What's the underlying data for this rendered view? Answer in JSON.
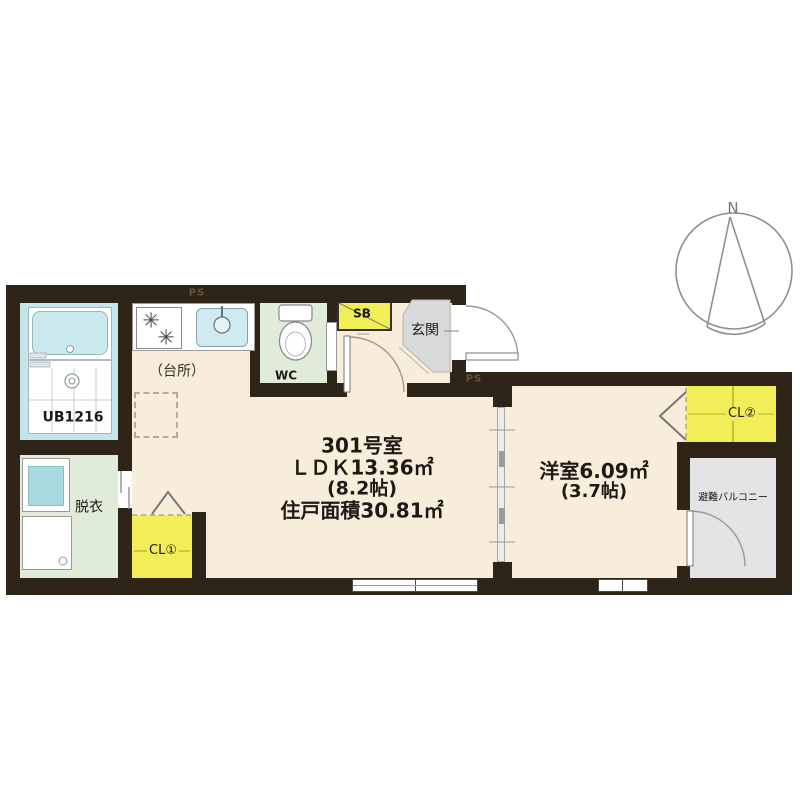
{
  "plan": {
    "compass": {
      "north_label": "N"
    },
    "ldk": {
      "room_number": "301号室",
      "ldk_area": "ＬＤＫ13.36㎡",
      "ldk_tatami": "(8.2帖)",
      "total_area": "住戸面積30.81㎡"
    },
    "western_room": {
      "area": "洋室6.09㎡",
      "tatami": "(3.7帖)"
    },
    "labels": {
      "unit_bath": "UB1216",
      "dressing_room": "脱衣",
      "kitchen": "（台所）",
      "wc": "WC",
      "shoe_box": "SB",
      "entrance": "玄関",
      "closet1": "CL①",
      "closet2": "CL②",
      "balcony": "避難バルコニー",
      "pipe_space_top": "PS",
      "pipe_space_right": "PS"
    },
    "icons": {
      "burner": "✳"
    },
    "colors": {
      "wall": "#2e2418",
      "floor_cream": "#f8ecdb",
      "wet_green": "#e0ebd9",
      "bath_cyan": "#c3e5eb",
      "closet_yellow": "#f2ee58",
      "entry_gray": "#d8d9da",
      "balcony_gray": "#e4e4e6",
      "sink_blue": "#cfeaf0",
      "line_gray": "#909090",
      "text_dark": "#1d1a16"
    }
  }
}
